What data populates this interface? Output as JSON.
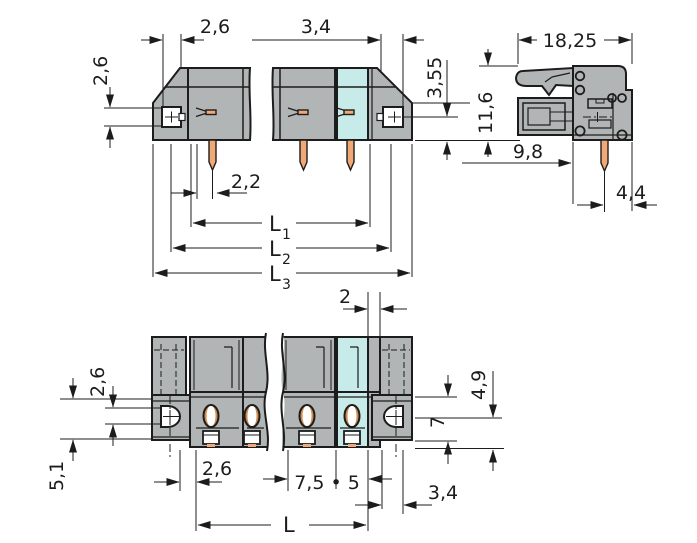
{
  "title": "Connector technical drawing",
  "colors": {
    "bg": "#ffffff",
    "line": "#1c1c1c",
    "body": "#b2b5b5",
    "accent": "#c7ebe9",
    "pin": "#f0a877",
    "pin_dark": "#d08a4e",
    "hole": "#ffffff"
  },
  "dims": {
    "front": {
      "top_width": "2,6",
      "side_height": "2,6",
      "right_width": "3,4",
      "right_height": "3,55",
      "pin_offset": "2,2",
      "l1_base": "L",
      "l1_sub": "1",
      "l2_base": "L",
      "l2_sub": "2",
      "l3_base": "L",
      "l3_sub": "3"
    },
    "side": {
      "total_width": "18,25",
      "total_height": "11,6",
      "depth": "9,8",
      "pin_to_edge": "4,4"
    },
    "bottom": {
      "gap": "2",
      "flange_height": "2,6",
      "flange_span": "5,1",
      "edge_offset": "2,6",
      "pitch": "7,5 • 5",
      "length": "L",
      "tab_height": "4,9",
      "body_height": "7",
      "corner_offset": "3,4"
    }
  }
}
